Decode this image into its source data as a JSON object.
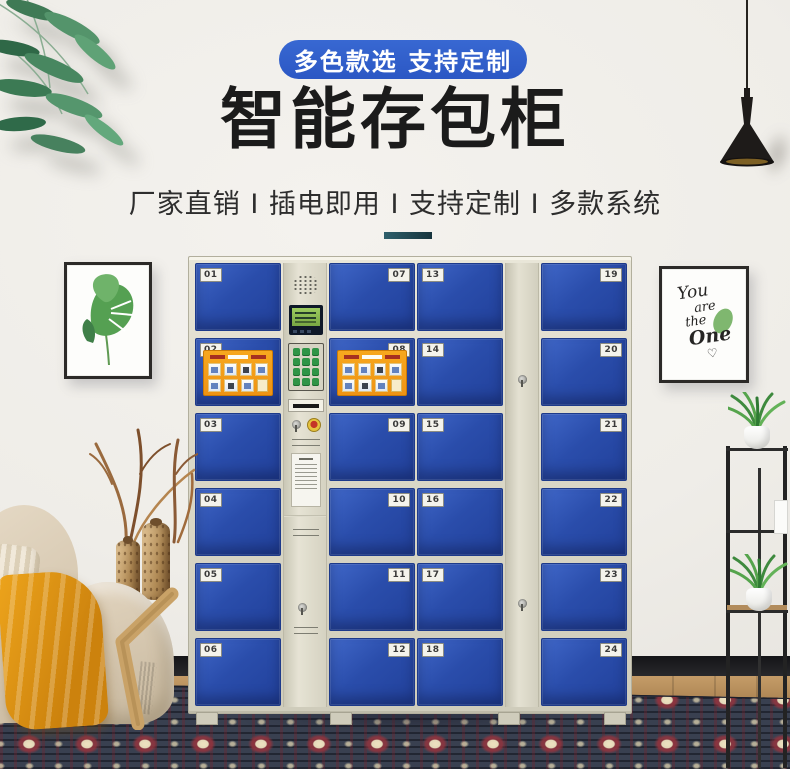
{
  "banner": {
    "label": "多色款选 支持定制"
  },
  "heading": {
    "title": "智能存包柜",
    "subtitle": "厂家直销 I 插电即用 I 支持定制 I 多款系统"
  },
  "locker": {
    "doors": [
      {
        "number": "01"
      },
      {
        "number": "02"
      },
      {
        "number": "03"
      },
      {
        "number": "04"
      },
      {
        "number": "05"
      },
      {
        "number": "06"
      },
      {
        "number": "07"
      },
      {
        "number": "08"
      },
      {
        "number": "09"
      },
      {
        "number": "10"
      },
      {
        "number": "11"
      },
      {
        "number": "12"
      },
      {
        "number": "13"
      },
      {
        "number": "14"
      },
      {
        "number": "15"
      },
      {
        "number": "16"
      },
      {
        "number": "17"
      },
      {
        "number": "18"
      },
      {
        "number": "19"
      },
      {
        "number": "20"
      },
      {
        "number": "21"
      },
      {
        "number": "22"
      },
      {
        "number": "23"
      },
      {
        "number": "24"
      }
    ]
  },
  "wall_art": {
    "quote_lines": [
      "You",
      "are",
      "the",
      "One"
    ],
    "heart": "♡"
  },
  "colors": {
    "accent-blue": "#2b57c4",
    "door-blue": "#2a4dab",
    "cabinet-beige": "#dcd9c9",
    "sticker-orange": "#f7a81f",
    "divider-teal": "#16343d",
    "blanket-orange": "#e69c18"
  }
}
